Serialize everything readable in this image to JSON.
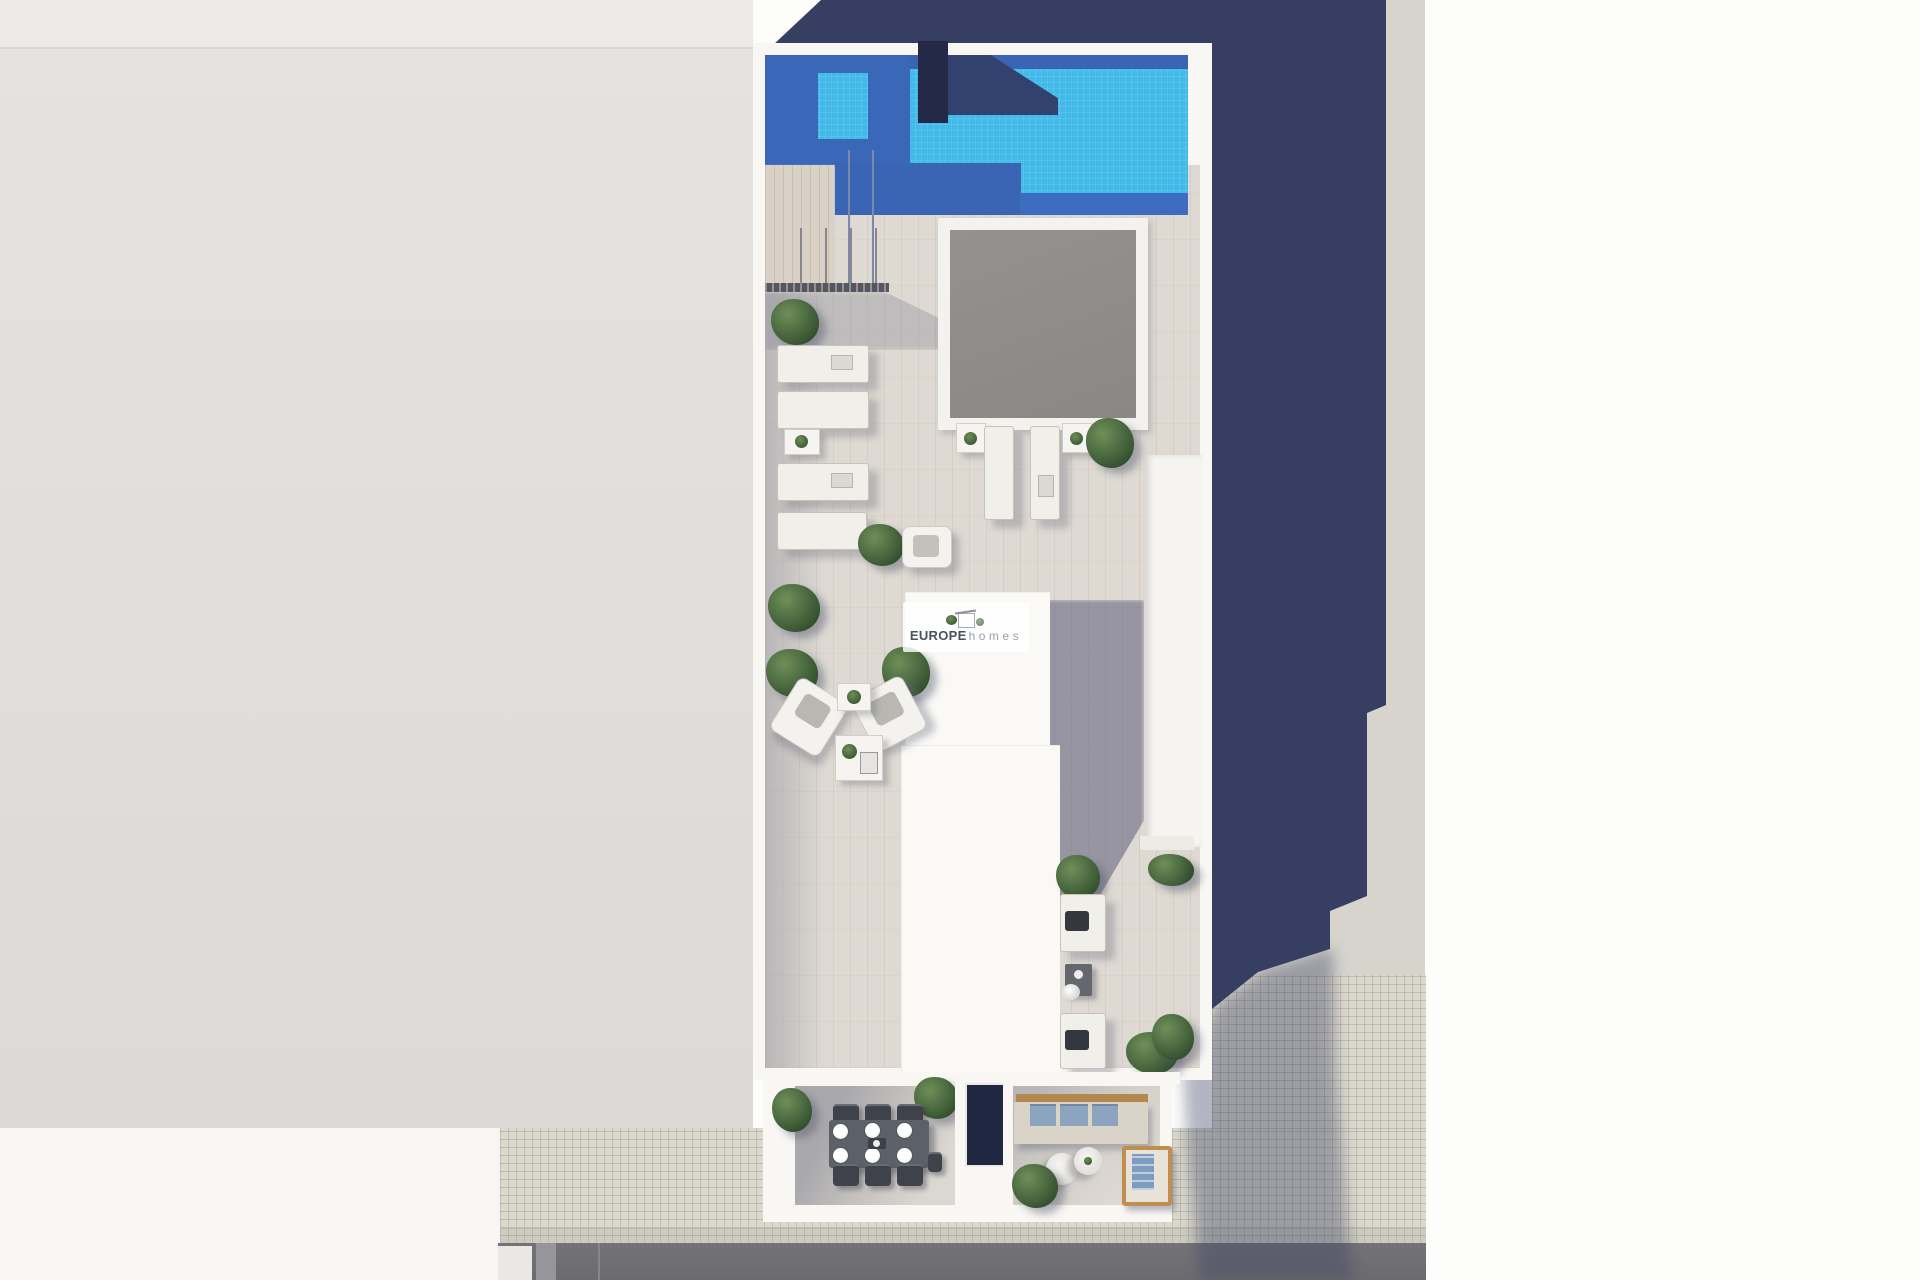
{
  "watermark": {
    "brand": "EUROPE",
    "suffix": "homes"
  },
  "palette": {
    "pool_water": "#41b9e9",
    "pool_shadow": "#3a65b6",
    "pool_deep_shadow": "#33416f",
    "cast_shadow_navy": "#363e62",
    "walls_white": "#f8f7f4",
    "terrace_floor": "#ded9d2",
    "skylight_glass": "#8f8c8a",
    "ground_left": "#e2e0dc",
    "ground_right": "#d6d4cd",
    "sidewalk_tiles": "#dbd8cd",
    "road_asphalt": "#6f6e72",
    "greenery": "#41603a",
    "sofa_cushion_blue": "#8ca4bf",
    "armchair_wood": "#bf8e51",
    "dining_table": "#5c6068"
  },
  "scene": {
    "type": "aerial 3D render of a rooftop terrace floor plan",
    "areas": [
      {
        "name": "swimming-pool"
      },
      {
        "name": "pool-deck-with-handrail"
      },
      {
        "name": "sun-lounger-row",
        "loungers": 4
      },
      {
        "name": "skylight-courtyard"
      },
      {
        "name": "skylight-loungers",
        "loungers": 2
      },
      {
        "name": "lounge-seating-corner",
        "armchairs": 2,
        "tables": 2
      },
      {
        "name": "stair-elevator-housing"
      },
      {
        "name": "side-chill-corridor",
        "chairs": 2
      },
      {
        "name": "dining-terrace",
        "seats": 6
      },
      {
        "name": "sofa-terrace",
        "sofas": 1,
        "round_tables": 2,
        "armchairs": 1
      },
      {
        "name": "street-sidewalk"
      },
      {
        "name": "road"
      }
    ]
  }
}
